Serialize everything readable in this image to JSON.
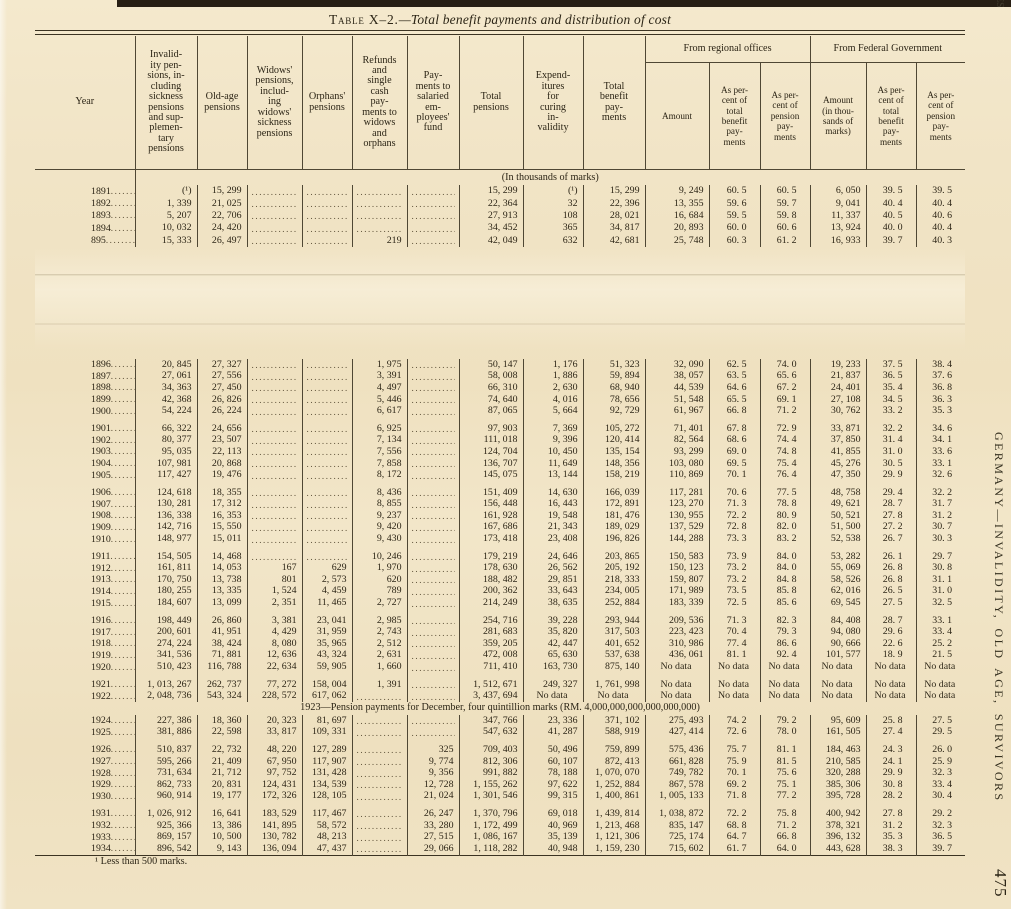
{
  "page": {
    "title_caps": "Table X–2.",
    "title_rest": "—Total benefit payments and distribution of cost",
    "footnote": "¹ Less than 500 marks.",
    "side_text": "GERMANY—INVALIDITY, OLD AGE, SURVIVORS",
    "page_number": "475",
    "corner_mark": "ES"
  },
  "table": {
    "unit_note": "(In thousands of marks)",
    "group_headers": [
      "From regional offices",
      "From Federal Government"
    ],
    "headers": [
      "Year",
      "Invalid-\nity pen-\nsions, in-\ncluding\nsickness\npensions\nand sup-\nplemen-\ntary\npensions",
      "Old-age\npensions",
      "Widows'\npensions,\ninclud-\ning\nwidows'\nsickness\npensions",
      "Orphans'\npensions",
      "Refunds\nand\nsingle\ncash\npay-\nments to\nwidows\nand\norphans",
      "Pay-\nments to\nsalaried\nem-\nployees'\nfund",
      "Total\npensions",
      "Expend-\nitures\nfor\ncuring\nin-\nvalidity",
      "Total\nbenefit\npay-\nments",
      "Amount",
      "As per-\ncent of\ntotal\nbenefit\npay-\nments",
      "As per-\ncent of\npension\npay-\nments",
      "Amount\n(in thou-\nsands of\nmarks)",
      "As per-\ncent of\ntotal\nbenefit\npay-\nments",
      "As per-\ncent of\npension\npay-\nments"
    ],
    "block1": {
      "rows": [
        [
          "1891",
          "(¹)",
          "15, 299",
          null,
          null,
          null,
          null,
          "15, 299",
          "(¹)",
          "15, 299",
          "9, 249",
          "60. 5",
          "60. 5",
          "6, 050",
          "39. 5",
          "39. 5"
        ],
        [
          "1892",
          "1, 339",
          "21, 025",
          null,
          null,
          null,
          null,
          "22, 364",
          "32",
          "22, 396",
          "13, 355",
          "59. 6",
          "59. 7",
          "9, 041",
          "40. 4",
          "40. 4"
        ],
        [
          "1893",
          "5, 207",
          "22, 706",
          null,
          null,
          null,
          null,
          "27, 913",
          "108",
          "28, 021",
          "16, 684",
          "59. 5",
          "59. 8",
          "11, 337",
          "40. 5",
          "40. 6"
        ],
        [
          "1894",
          "10, 032",
          "24, 420",
          null,
          null,
          null,
          null,
          "34, 452",
          "365",
          "34, 817",
          "20, 893",
          "60. 0",
          "60. 6",
          "13, 924",
          "40. 0",
          "40. 4"
        ],
        [
          "895",
          "15, 333",
          "26, 497",
          null,
          null,
          "219",
          null,
          "42, 049",
          "632",
          "42, 681",
          "25, 748",
          "60. 3",
          "61. 2",
          "16, 933",
          "39. 7",
          "40. 3"
        ]
      ]
    },
    "sections": [
      {
        "type": "rows",
        "rows": [
          [
            "1896",
            "20, 845",
            "27, 327",
            null,
            null,
            "1, 975",
            null,
            "50, 147",
            "1, 176",
            "51, 323",
            "32, 090",
            "62. 5",
            "74. 0",
            "19, 233",
            "37. 5",
            "38. 4"
          ],
          [
            "1897",
            "27, 061",
            "27, 556",
            null,
            null,
            "3, 391",
            null,
            "58, 008",
            "1, 886",
            "59, 894",
            "38, 057",
            "63. 5",
            "65. 6",
            "21, 837",
            "36. 5",
            "37. 6"
          ],
          [
            "1898",
            "34, 363",
            "27, 450",
            null,
            null,
            "4, 497",
            null,
            "66, 310",
            "2, 630",
            "68, 940",
            "44, 539",
            "64. 6",
            "67. 2",
            "24, 401",
            "35. 4",
            "36. 8"
          ],
          [
            "1899",
            "42, 368",
            "26, 826",
            null,
            null,
            "5, 446",
            null,
            "74, 640",
            "4, 016",
            "78, 656",
            "51, 548",
            "65. 5",
            "69. 1",
            "27, 108",
            "34. 5",
            "36. 3"
          ],
          [
            "1900",
            "54, 224",
            "26, 224",
            null,
            null,
            "6, 617",
            null,
            "87, 065",
            "5, 664",
            "92, 729",
            "61, 967",
            "66. 8",
            "71. 2",
            "30, 762",
            "33. 2",
            "35. 3"
          ]
        ]
      },
      {
        "type": "gap"
      },
      {
        "type": "rows",
        "rows": [
          [
            "1901",
            "66, 322",
            "24, 656",
            null,
            null,
            "6, 925",
            null,
            "97, 903",
            "7, 369",
            "105, 272",
            "71, 401",
            "67. 8",
            "72. 9",
            "33, 871",
            "32. 2",
            "34. 6"
          ],
          [
            "1902",
            "80, 377",
            "23, 507",
            null,
            null,
            "7, 134",
            null,
            "111, 018",
            "9, 396",
            "120, 414",
            "82, 564",
            "68. 6",
            "74. 4",
            "37, 850",
            "31. 4",
            "34. 1"
          ],
          [
            "1903",
            "95, 035",
            "22, 113",
            null,
            null,
            "7, 556",
            null,
            "124, 704",
            "10, 450",
            "135, 154",
            "93, 299",
            "69. 0",
            "74. 8",
            "41, 855",
            "31. 0",
            "33. 6"
          ],
          [
            "1904",
            "107, 981",
            "20, 868",
            null,
            null,
            "7, 858",
            null,
            "136, 707",
            "11, 649",
            "148, 356",
            "103, 080",
            "69. 5",
            "75. 4",
            "45, 276",
            "30. 5",
            "33. 1"
          ],
          [
            "1905",
            "117, 427",
            "19, 476",
            null,
            null,
            "8, 172",
            null,
            "145, 075",
            "13, 144",
            "158, 219",
            "110, 869",
            "70. 1",
            "76. 4",
            "47, 350",
            "29. 9",
            "32. 6"
          ]
        ]
      },
      {
        "type": "gap"
      },
      {
        "type": "rows",
        "rows": [
          [
            "1906",
            "124, 618",
            "18, 355",
            null,
            null,
            "8, 436",
            null,
            "151, 409",
            "14, 630",
            "166, 039",
            "117, 281",
            "70. 6",
            "77. 5",
            "48, 758",
            "29. 4",
            "32. 2"
          ],
          [
            "1907",
            "130, 281",
            "17, 312",
            null,
            null,
            "8, 855",
            null,
            "156, 448",
            "16, 443",
            "172, 891",
            "123, 270",
            "71. 3",
            "78. 8",
            "49, 621",
            "28. 7",
            "31. 7"
          ],
          [
            "1908",
            "136, 338",
            "16, 353",
            null,
            null,
            "9, 237",
            null,
            "161, 928",
            "19, 548",
            "181, 476",
            "130, 955",
            "72. 2",
            "80. 9",
            "50, 521",
            "27. 8",
            "31. 2"
          ],
          [
            "1909",
            "142, 716",
            "15, 550",
            null,
            null,
            "9, 420",
            null,
            "167, 686",
            "21, 343",
            "189, 029",
            "137, 529",
            "72. 8",
            "82. 0",
            "51, 500",
            "27. 2",
            "30. 7"
          ],
          [
            "1910",
            "148, 977",
            "15, 011",
            null,
            null,
            "9, 430",
            null,
            "173, 418",
            "23, 408",
            "196, 826",
            "144, 288",
            "73. 3",
            "83. 2",
            "52, 538",
            "26. 7",
            "30. 3"
          ]
        ]
      },
      {
        "type": "gap"
      },
      {
        "type": "rows",
        "rows": [
          [
            "1911",
            "154, 505",
            "14, 468",
            null,
            null,
            "10, 246",
            null,
            "179, 219",
            "24, 646",
            "203, 865",
            "150, 583",
            "73. 9",
            "84. 0",
            "53, 282",
            "26. 1",
            "29. 7"
          ],
          [
            "1912",
            "161, 811",
            "14, 053",
            "167",
            "629",
            "1, 970",
            null,
            "178, 630",
            "26, 562",
            "205, 192",
            "150, 123",
            "73. 2",
            "84. 0",
            "55, 069",
            "26. 8",
            "30. 8"
          ],
          [
            "1913",
            "170, 750",
            "13, 738",
            "801",
            "2, 573",
            "620",
            null,
            "188, 482",
            "29, 851",
            "218, 333",
            "159, 807",
            "73. 2",
            "84. 8",
            "58, 526",
            "26. 8",
            "31. 1"
          ],
          [
            "1914",
            "180, 255",
            "13, 335",
            "1, 524",
            "4, 459",
            "789",
            null,
            "200, 362",
            "33, 643",
            "234, 005",
            "171, 989",
            "73. 5",
            "85. 8",
            "62, 016",
            "26. 5",
            "31. 0"
          ],
          [
            "1915",
            "184, 607",
            "13, 099",
            "2, 351",
            "11, 465",
            "2, 727",
            null,
            "214, 249",
            "38, 635",
            "252, 884",
            "183, 339",
            "72. 5",
            "85. 6",
            "69, 545",
            "27. 5",
            "32. 5"
          ]
        ]
      },
      {
        "type": "gap"
      },
      {
        "type": "rows",
        "rows": [
          [
            "1916",
            "198, 449",
            "26, 860",
            "3, 381",
            "23, 041",
            "2, 985",
            null,
            "254, 716",
            "39, 228",
            "293, 944",
            "209, 536",
            "71. 3",
            "82. 3",
            "84, 408",
            "28. 7",
            "33. 1"
          ],
          [
            "1917",
            "200, 601",
            "41, 951",
            "4, 429",
            "31, 959",
            "2, 743",
            null,
            "281, 683",
            "35, 820",
            "317, 503",
            "223, 423",
            "70. 4",
            "79. 3",
            "94, 080",
            "29. 6",
            "33. 4"
          ],
          [
            "1918",
            "274, 224",
            "38, 424",
            "8, 080",
            "35, 965",
            "2, 512",
            null,
            "359, 205",
            "42, 447",
            "401, 652",
            "310, 986",
            "77. 4",
            "86. 6",
            "90, 666",
            "22. 6",
            "25. 2"
          ],
          [
            "1919",
            "341, 536",
            "71, 881",
            "12, 636",
            "43, 324",
            "2, 631",
            null,
            "472, 008",
            "65, 630",
            "537, 638",
            "436, 061",
            "81. 1",
            "92. 4",
            "101, 577",
            "18. 9",
            "21. 5"
          ],
          [
            "1920",
            "510, 423",
            "116, 788",
            "22, 634",
            "59, 905",
            "1, 660",
            null,
            "711, 410",
            "163, 730",
            "875, 140",
            "No data",
            "No data",
            "No data",
            "No data",
            "No data",
            "No data"
          ]
        ]
      },
      {
        "type": "gap"
      },
      {
        "type": "rows",
        "rows": [
          [
            "1921",
            "1, 013, 267",
            "262, 737",
            "77, 272",
            "158, 004",
            "1, 391",
            null,
            "1, 512, 671",
            "249, 327",
            "1, 761, 998",
            "No data",
            "No data",
            "No data",
            "No data",
            "No data",
            "No data"
          ],
          [
            "1922",
            "2, 048, 736",
            "543, 324",
            "228, 572",
            "617, 062",
            null,
            null,
            "3, 437, 694",
            "No data",
            "No data",
            "No data",
            "No data",
            "No data",
            "No data",
            "No data",
            "No data"
          ]
        ]
      },
      {
        "type": "note",
        "text": "1923—Pension payments for December, four quintillion marks (RM. 4,000,000,000,000,000,000)"
      },
      {
        "type": "rows",
        "rows": [
          [
            "1924",
            "227, 386",
            "18, 360",
            "20, 323",
            "81, 697",
            null,
            null,
            "347, 766",
            "23, 336",
            "371, 102",
            "275, 493",
            "74. 2",
            "79. 2",
            "95, 609",
            "25. 8",
            "27. 5"
          ],
          [
            "1925",
            "381, 886",
            "22, 598",
            "33, 817",
            "109, 331",
            null,
            null,
            "547, 632",
            "41, 287",
            "588, 919",
            "427, 414",
            "72. 6",
            "78. 0",
            "161, 505",
            "27. 4",
            "29. 5"
          ]
        ]
      },
      {
        "type": "gap"
      },
      {
        "type": "rows",
        "rows": [
          [
            "1926",
            "510, 837",
            "22, 732",
            "48, 220",
            "127, 289",
            null,
            "325",
            "709, 403",
            "50, 496",
            "759, 899",
            "575, 436",
            "75. 7",
            "81. 1",
            "184, 463",
            "24. 3",
            "26. 0"
          ],
          [
            "1927",
            "595, 266",
            "21, 409",
            "67, 950",
            "117, 907",
            null,
            "9, 774",
            "812, 306",
            "60, 107",
            "872, 413",
            "661, 828",
            "75. 9",
            "81. 5",
            "210, 585",
            "24. 1",
            "25. 9"
          ],
          [
            "1928",
            "731, 634",
            "21, 712",
            "97, 752",
            "131, 428",
            null,
            "9, 356",
            "991, 882",
            "78, 188",
            "1, 070, 070",
            "749, 782",
            "70. 1",
            "75. 6",
            "320, 288",
            "29. 9",
            "32. 3"
          ],
          [
            "1929",
            "862, 733",
            "20, 831",
            "124, 431",
            "134, 539",
            null,
            "12, 728",
            "1, 155, 262",
            "97, 622",
            "1, 252, 884",
            "867, 578",
            "69. 2",
            "75. 1",
            "385, 306",
            "30. 8",
            "33. 4"
          ],
          [
            "1930",
            "960, 914",
            "19, 177",
            "172, 326",
            "128, 105",
            null,
            "21, 024",
            "1, 301, 546",
            "99, 315",
            "1, 400, 861",
            "1, 005, 133",
            "71. 8",
            "77. 2",
            "395, 728",
            "28. 2",
            "30. 4"
          ]
        ]
      },
      {
        "type": "gap"
      },
      {
        "type": "rows",
        "rows": [
          [
            "1931",
            "1, 026, 912",
            "16, 641",
            "183, 529",
            "117, 467",
            null,
            "26, 247",
            "1, 370, 796",
            "69, 018",
            "1, 439, 814",
            "1, 038, 872",
            "72. 2",
            "75. 8",
            "400, 942",
            "27. 8",
            "29. 2"
          ],
          [
            "1932",
            "925, 366",
            "13, 386",
            "141, 895",
            "58, 572",
            null,
            "33, 280",
            "1, 172, 499",
            "40, 969",
            "1, 213, 468",
            "835, 147",
            "68. 8",
            "71. 2",
            "378, 321",
            "31. 2",
            "32. 3"
          ],
          [
            "1933",
            "869, 157",
            "10, 500",
            "130, 782",
            "48, 213",
            null,
            "27, 515",
            "1, 086, 167",
            "35, 139",
            "1, 121, 306",
            "725, 174",
            "64. 7",
            "66. 8",
            "396, 132",
            "35. 3",
            "36. 5"
          ],
          [
            "1934",
            "896, 542",
            "9, 143",
            "136, 094",
            "47, 437",
            null,
            "29, 066",
            "1, 118, 282",
            "40, 948",
            "1, 159, 230",
            "715, 602",
            "61. 7",
            "64. 0",
            "443, 628",
            "38. 3",
            "39. 7"
          ]
        ]
      }
    ]
  }
}
